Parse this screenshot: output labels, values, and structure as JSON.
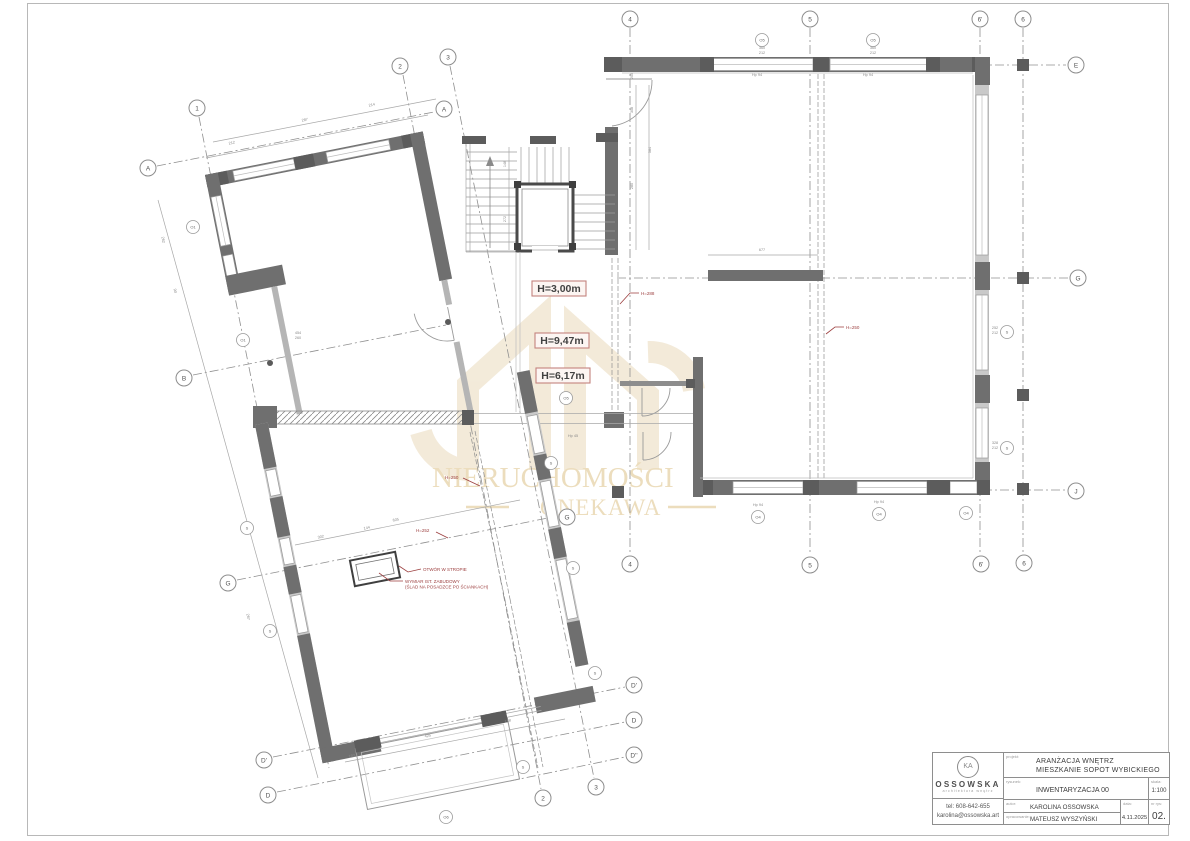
{
  "colors": {
    "wall": "#6f6f6f",
    "annotation_red": "#9c3f3f",
    "watermark_beige": "#ecddbd"
  },
  "watermark": {
    "line1": "NIERUCHOMOŚCI",
    "line2": "ONEKAWA"
  },
  "plan": {
    "heights": [
      {
        "text": "H=3,00m"
      },
      {
        "text": "H=9,47m"
      },
      {
        "text": "H=6,17m"
      }
    ],
    "leaders": [
      {
        "text": "H=288"
      },
      {
        "text": "H=250"
      },
      {
        "text": "H=250"
      },
      {
        "text": "H=252"
      }
    ],
    "notes": {
      "otwor": "OTWÓR W STROPIE",
      "wymiar_line1": "WYMIAR IST. ZABUDOWY",
      "wymiar_line2": "(ŚLAD NA POSADZCE PO ŚCIANKACH)"
    },
    "bubbles": [
      {
        "label": "1"
      },
      {
        "label": "2"
      },
      {
        "label": "3"
      },
      {
        "label": "4"
      },
      {
        "label": "5"
      },
      {
        "label": "6'"
      },
      {
        "label": "6"
      },
      {
        "label": "E"
      },
      {
        "label": "A"
      },
      {
        "label": "A"
      },
      {
        "label": "B"
      },
      {
        "label": "G"
      },
      {
        "label": "G"
      },
      {
        "label": "J"
      },
      {
        "label": "D'"
      },
      {
        "label": "D"
      },
      {
        "label": "D''"
      },
      {
        "label": "D'"
      },
      {
        "label": "D"
      },
      {
        "label": "2"
      },
      {
        "label": "3"
      },
      {
        "label": "4"
      },
      {
        "label": "5"
      },
      {
        "label": "6'"
      },
      {
        "label": "6"
      },
      {
        "label": "G"
      }
    ],
    "markers": [
      {
        "label": "O5"
      },
      {
        "label": "O5"
      },
      {
        "label": "O5"
      },
      {
        "label": "O4"
      },
      {
        "label": "O4"
      },
      {
        "label": "O4"
      },
      {
        "label": "S"
      },
      {
        "label": "S"
      },
      {
        "label": "O1"
      },
      {
        "label": "O1"
      },
      {
        "label": "S"
      },
      {
        "label": "S"
      },
      {
        "label": "S"
      },
      {
        "label": "S"
      },
      {
        "label": "S"
      },
      {
        "label": "S"
      },
      {
        "label": "O6"
      }
    ],
    "dims": [
      {
        "t": "212"
      },
      {
        "t": "287"
      },
      {
        "t": "214"
      },
      {
        "t": "205"
      },
      {
        "t": "308"
      },
      {
        "t": "280"
      },
      {
        "t": "584"
      },
      {
        "t": "148"
      },
      {
        "t": "272"
      },
      {
        "t": "677"
      },
      {
        "t": "302"
      },
      {
        "t": "144"
      },
      {
        "t": "605"
      },
      {
        "t": "425"
      },
      {
        "t": "168"
      },
      {
        "t": "193"
      },
      {
        "t": "262"
      },
      {
        "t": "90"
      },
      {
        "t": "267"
      },
      {
        "t": "Hp 94"
      },
      {
        "t": "Hp 94"
      },
      {
        "t": "360"
      },
      {
        "t": "212"
      },
      {
        "t": "360"
      },
      {
        "t": "212"
      },
      {
        "t": "252"
      },
      {
        "t": "212"
      },
      {
        "t": "328"
      },
      {
        "t": "212"
      },
      {
        "t": "454"
      },
      {
        "t": "260"
      },
      {
        "t": "Hp 45"
      },
      {
        "t": "Hp 94"
      },
      {
        "t": "Hp 94"
      }
    ]
  },
  "title_block": {
    "logo": {
      "monogram": "KA",
      "name": "OSSOWSKA",
      "subtitle": "architektura wnętrz"
    },
    "contact": {
      "phone": "tel: 608-642-655",
      "email": "karolina@ossowska.art"
    },
    "projekt_label": "projekt:",
    "projekt_line1": "ARANŻACJA WNĘTRZ",
    "projekt_line2": "MIESZKANIE SOPOT WYBICKIEGO",
    "rysunek_label": "rysunek:",
    "rysunek_value": "INWENTARYZACJA 00",
    "skala_label": "skala:",
    "skala_value": "1:100",
    "autor_label": "autor:",
    "autor_value": "KAROLINA OSSOWSKA",
    "opracowanie_label": "opracowanie:",
    "opracowanie_value": "MATEUSZ WYSZYŃSKI",
    "data_label": "data:",
    "data_value": "4.11.2025",
    "nr_label": "nr rys:",
    "nr_value": "02."
  }
}
